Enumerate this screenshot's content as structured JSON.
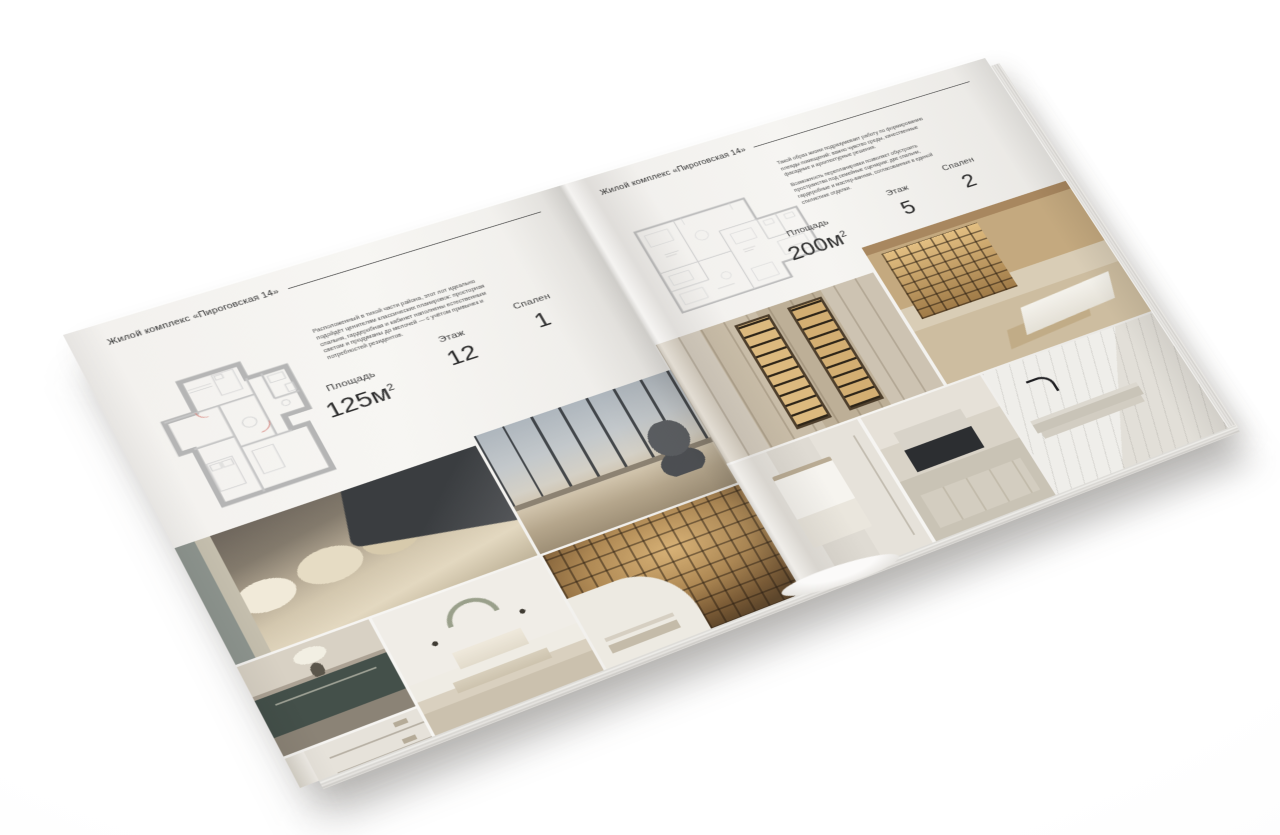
{
  "page_left": {
    "header": "Жилой комплекс «Пироговская 14»",
    "description": "Расположенный в тихой части района, этот лот идеально подойдёт ценителям классических планировок: просторная спальня, гардеробная и кабинет наполнены естественным светом и продуманы до мелочей — с учётом привычек и потребностей резидентов.",
    "stats": {
      "area_label": "Площадь",
      "area_value": "125м",
      "area_sup": "2",
      "floor_label": "Этаж",
      "floor_value": "12",
      "bedrooms_label": "Спален",
      "bedrooms_value": "1"
    },
    "photos": [
      "bedroom-pillows-closeup",
      "panoramic-window-bedroom",
      "dresser-with-flowers",
      "white-shelving-unit",
      "bedroom-with-bench",
      "home-library"
    ]
  },
  "page_right": {
    "header": "Жилой комплекс «Пироговская 14»",
    "description_1": "Такой образ жизни подразумевает работу по формированию плеяды помещений: важно чувство среды, качественные фасадные и архитектурные решения.",
    "description_2": "Возможность перепланировки позволяет обустроить пространство под семейные сценарии: две спальни, гардеробные и мастер-ванная, согласованные в единой стилистике отделки.",
    "stats": {
      "area_label": "Площадь",
      "area_value": "200м",
      "area_sup": "2",
      "floor_label": "Этаж",
      "floor_value": "5",
      "bedrooms_label": "Спален",
      "bedrooms_value": "2"
    },
    "photos": [
      "wardrobe-lit-cabinets",
      "study-with-white-desk",
      "bathroom-with-towel",
      "kitchen-dark-cooktop",
      "marble-washbasin"
    ]
  },
  "colors": {
    "paper": "#f4f3f0",
    "ink": "#2e2e2e",
    "photo_warm_wood": "#b08a55",
    "photo_dark_furniture": "#4a4c50"
  }
}
